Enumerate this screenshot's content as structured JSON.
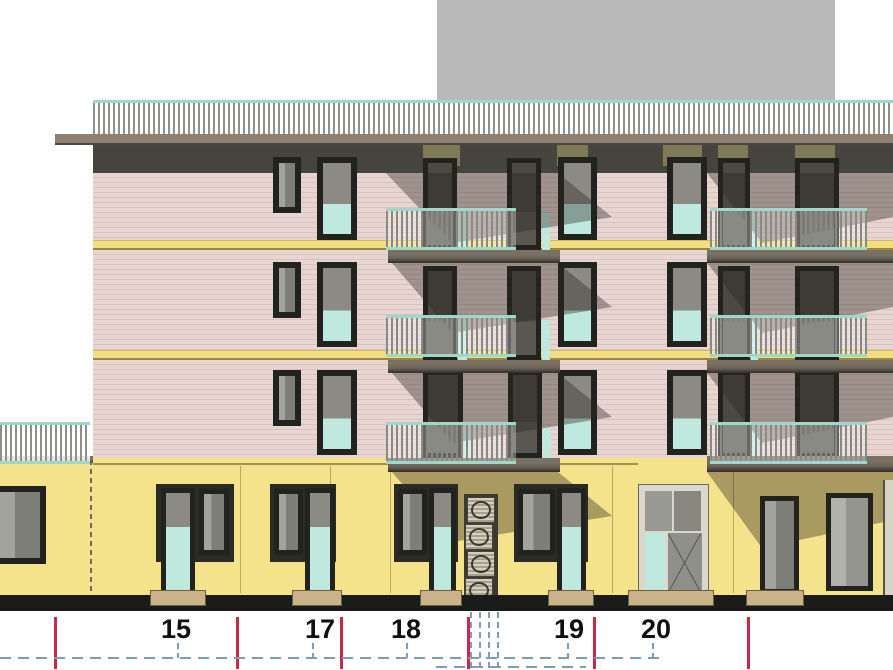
{
  "drawing": {
    "type": "architectural-elevation",
    "building": {
      "upper_floors": 3,
      "facade_features": [
        "roof-terrace-railing",
        "balconies-with-railings",
        "french-windows",
        "entrance-door",
        "glass-block-column",
        "left-low-wing"
      ]
    },
    "annotation": {
      "unit_labels": [
        {
          "label": "15",
          "x": 176
        },
        {
          "label": "17",
          "x": 320
        },
        {
          "label": "18",
          "x": 406
        },
        {
          "label": "19",
          "x": 569
        },
        {
          "label": "20",
          "x": 656
        }
      ],
      "red_marker_lines_x": [
        55,
        237,
        341,
        468,
        594,
        748
      ]
    },
    "palette": {
      "wall_pink": "#e7d5d1",
      "wall_stripe": "#d8c2be",
      "wall_yellow": "#f5e38c",
      "band_yellow": "#f2dd82",
      "fascia_dark": "#45453e",
      "roof_slab": "#8c8172",
      "background_block_gray": "#b9b9b9",
      "frame_dark": "#22221e",
      "glass_gray": "#7e7e78",
      "glass_teal": "#bfe9df",
      "railing_teal": "#9fd8c9",
      "slab_face": "#6a6156",
      "olive_panel": "#7e7a57",
      "shadow_color": "rgba(42,37,30,0.38)",
      "red_marker": "#c62a47",
      "leader_blue": "#7f9cb5",
      "base_dark": "#1b1b19",
      "sill_beige": "#c9b489"
    }
  }
}
